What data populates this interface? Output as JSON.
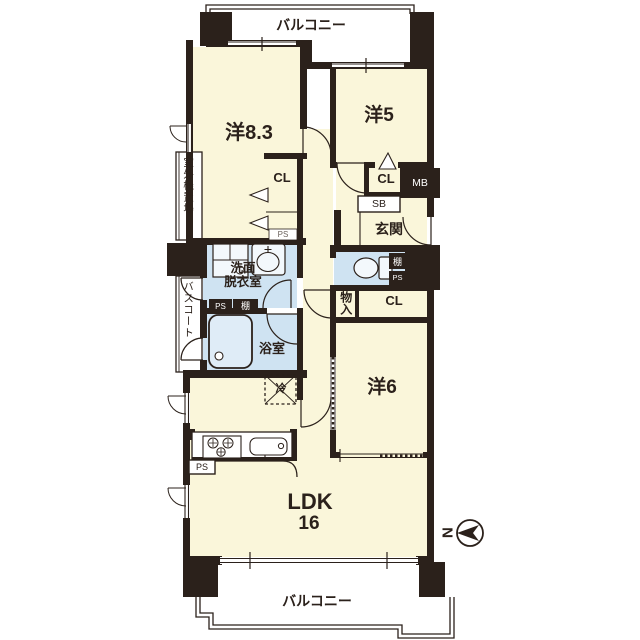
{
  "title": "apartment-floor-plan",
  "colors": {
    "wall": "#2b211b",
    "cream": "#faf6da",
    "wet": "#cfe3f2",
    "fixture": "#f3f8fc",
    "tub": "#dfecf7"
  },
  "labels": {
    "balcony_top": "バルコニー",
    "balcony_bottom": "バルコニー",
    "room_83": "洋8.3",
    "room_5": "洋5",
    "room_6": "洋6",
    "ldk_name": "LDK",
    "ldk_size": "16",
    "closet_83": "CL",
    "closet_5": "CL",
    "closet_6": "CL",
    "entrance": "玄関",
    "washroom": "洗面\n脱衣室",
    "bathroom": "浴室",
    "outdoor_unit": "室外機置場",
    "bath_court": "バスコート",
    "storage": "物入",
    "meter_box": "MB",
    "shoe_box": "SB",
    "shelf_washroom": "棚",
    "shelf_toilet": "棚",
    "ps_closet": "PS",
    "ps_washroom": "PS",
    "ps_toilet": "PS",
    "ps_kitchen": "PS",
    "fridge": "冷",
    "compass_north": "N"
  }
}
